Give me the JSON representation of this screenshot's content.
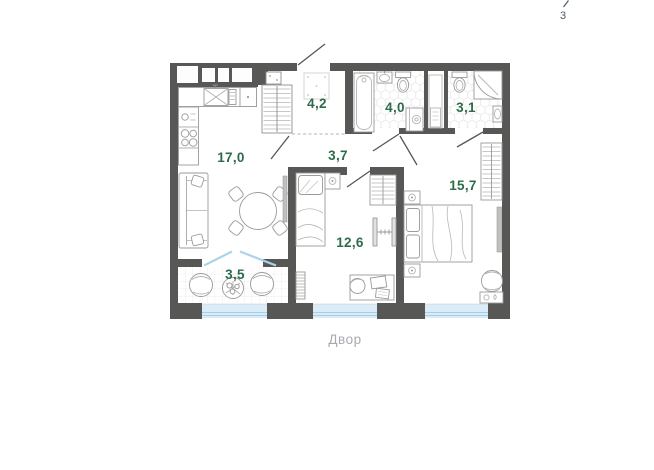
{
  "page": {
    "number": "3"
  },
  "plan": {
    "courtyard_label": "Двор",
    "rooms": [
      {
        "id": "kitchen-living-room",
        "area": "17,0"
      },
      {
        "id": "hallway",
        "area": "4,2"
      },
      {
        "id": "bathroom",
        "area": "4,0"
      },
      {
        "id": "shower-room",
        "area": "3,1"
      },
      {
        "id": "corridor",
        "area": "3,7"
      },
      {
        "id": "bedroom-small",
        "area": "12,6"
      },
      {
        "id": "bedroom-master",
        "area": "15,7"
      },
      {
        "id": "balcony",
        "area": "3,5"
      }
    ],
    "colors": {
      "walls": "#575756",
      "room_label": "#2e6b4a",
      "courtyard_label": "#a7abb0",
      "window_glass": "#d9ecf7",
      "window_frame": "#a5cfe6",
      "page_number": "#4d5a66"
    }
  }
}
